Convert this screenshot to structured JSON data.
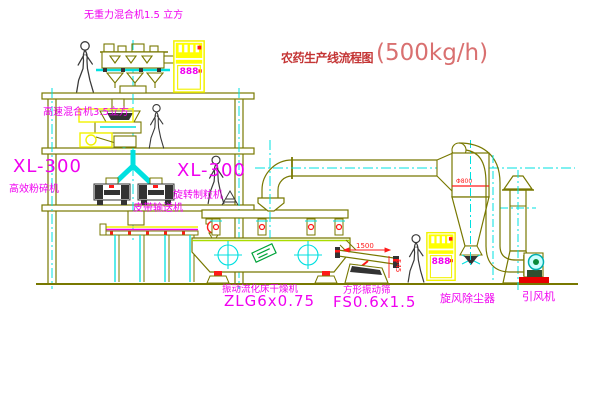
{
  "title": {
    "text": "农药生产线流程图",
    "capacity": "(500kg/h)"
  },
  "labels": {
    "gravity_mixer": "无重力混合机1.5 立方",
    "high_speed_mixer": "高速混合机3.5立方",
    "crusher_model": "XL-300",
    "crusher_name": "高效粉碎机",
    "granulator_model": "XL-300",
    "granulator_name": "旋转制粒机",
    "belt_conveyor": "皮带输送机",
    "dryer_name": "振动流化床干燥机",
    "dryer_model": "ZLG6x0.75",
    "screen_name": "方形振动筛",
    "screen_model": "FS0.6x1.5",
    "cyclone": "旋风除尘器",
    "fan": "引风机"
  },
  "dimensions": {
    "screen_length": "1500",
    "screen_height": "545",
    "cyclone_dia": "Φ800"
  },
  "cabinets": {
    "display_text": "888"
  },
  "colors": {
    "line": "#787800",
    "centerline": "#00e0e0",
    "label": "#f000f0",
    "title_red": "#c43535",
    "highlight_yellow": "#ffff00",
    "accent_red": "#ff1a1a",
    "tag_green": "#00a33a"
  }
}
